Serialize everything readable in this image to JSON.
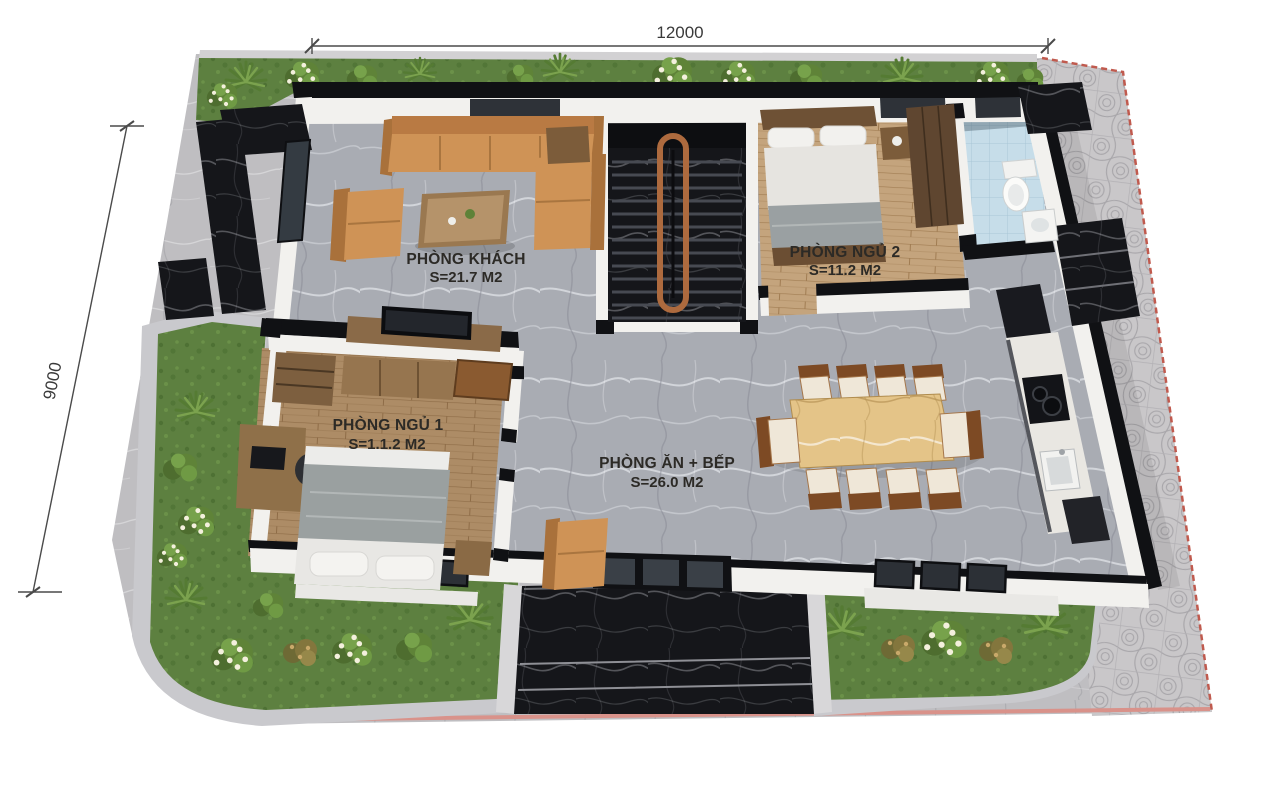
{
  "labels": {
    "dimension_width": "12000",
    "dimension_depth": "9000"
  },
  "rooms": {
    "living": {
      "name": "PHÒNG KHÁCH",
      "area": "S=21.7 M2"
    },
    "bedroom1": {
      "name": "PHÒNG NGỦ 1",
      "area": "S=1.1.2 M2"
    },
    "bedroom2": {
      "name": "PHÒNG NGỦ 2",
      "area": "S=11.2 M2"
    },
    "dining_kitchen": {
      "name": "PHÒNG ĂN + BẾP",
      "area": "S=26.0 M2"
    }
  },
  "colors": {
    "background": "#ffffff",
    "pavement": "#bfbec1",
    "sidewalk_tile": "#c9c7c9",
    "lot_edge_red": "#c05a4e",
    "grass": "#5d8040",
    "curb_stone": "#c9c9cd",
    "wall_black": "#101114",
    "wall_white": "#f2f1ee",
    "black_marble": "#15161a",
    "gray_marble_floor": "#a9acb3",
    "wood_floor": "#ad8c66",
    "wood_floor_light": "#c4a47d",
    "gold_marble_table": "#e4c488",
    "sofa_tan": "#cf9356",
    "chair_brown": "#7d4a24",
    "bathroom_tile_blue": "#c6dde9",
    "handrail_copper": "#ad6a3e",
    "dimension_line": "#4a4a4a",
    "label_text": "#2c2a26"
  }
}
